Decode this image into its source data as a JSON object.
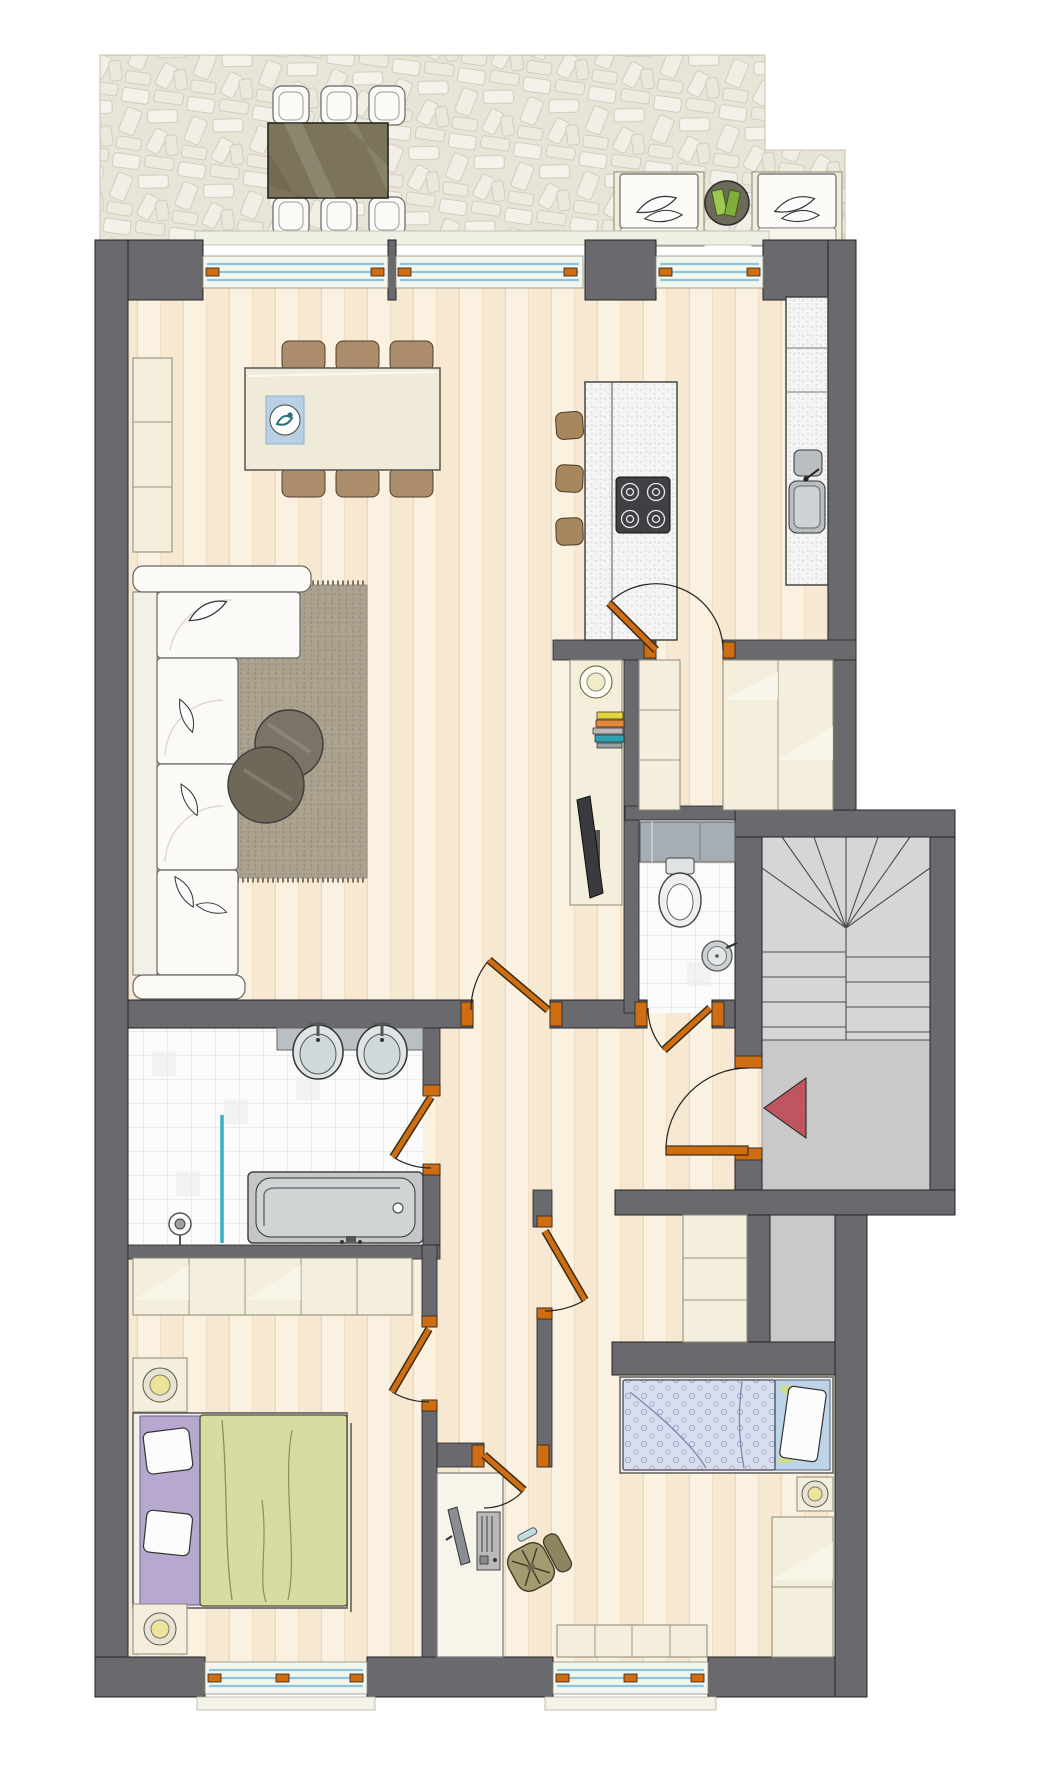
{
  "title": "Apartment floor plan with roof terrace and stairwell",
  "palette": {
    "wall": "#6a6a6e",
    "landing": "#c9c9c9",
    "stairs": "#d6d6d6",
    "cream": "#f4efdd",
    "sofa-white": "#fbfaf7",
    "glass-blue": "#8fc4dd",
    "door-orange": "#cf6d13",
    "arrow-red": "#c05562",
    "rug": "#aba290",
    "chair-brown": "#ab8d6c",
    "stool-brown": "#a8875f",
    "table-olive": "#7c745a",
    "duvet-green": "#d7dda1",
    "sheet-purple": "#b6a8ce",
    "duvet-blue": "#d8deee",
    "sheet-blue": "#bdd3e8",
    "fixture-gray": "#c3c7c8",
    "tv-dark": "#3a3a3e",
    "book-green": "#8fb13d"
  },
  "rooms": {
    "terrace": {
      "label": "Terrace",
      "items": [
        "outdoor dining table",
        "6 outdoor chairs",
        "2 lounge armchairs with cushions",
        "round side table",
        "open green book"
      ]
    },
    "living": {
      "label": "Living / dining room",
      "items": [
        "dining table with 6 chairs",
        "blue placemat with decorative bowl",
        "corner sofa with cushions",
        "area rug",
        "2 round coffee tables",
        "tall cabinet",
        "lowboard with TV, bowl and stacked books"
      ]
    },
    "kitchen": {
      "label": "Kitchen",
      "items": [
        "island with 4-burner cooktop",
        "3 bar stools",
        "tall counter with sink"
      ]
    },
    "hallway": {
      "label": "Hallway",
      "items": [
        "built-in wardrobes on both sides"
      ]
    },
    "wc": {
      "label": "Guest WC",
      "items": [
        "wall-hung toilet",
        "round washbasin"
      ]
    },
    "bathroom": {
      "label": "Bathroom",
      "items": [
        "double washbasin counter",
        "bathtub",
        "shower with glass screen"
      ]
    },
    "bedroom": {
      "label": "Bedroom",
      "items": [
        "double bed with purple sheet and green duvet",
        "2 nightstands with lamps",
        "wardrobe row"
      ]
    },
    "kidsroom": {
      "label": "Kids room / office",
      "items": [
        "single bed with dotted blue duvet",
        "nightstand with lamp",
        "wardrobe",
        "chest of drawers",
        "desk with monitor and PC",
        "swivel chair",
        "low sideboard"
      ]
    },
    "stairwell": {
      "label": "Stairwell",
      "items": [
        "winder staircase",
        "landing",
        "red entrance arrow"
      ]
    }
  },
  "elements": {
    "windows_top": 3,
    "windows_bottom": 2,
    "interior_doors": 7,
    "entrance_doors": 1,
    "entrance_arrow_direction": "left"
  }
}
